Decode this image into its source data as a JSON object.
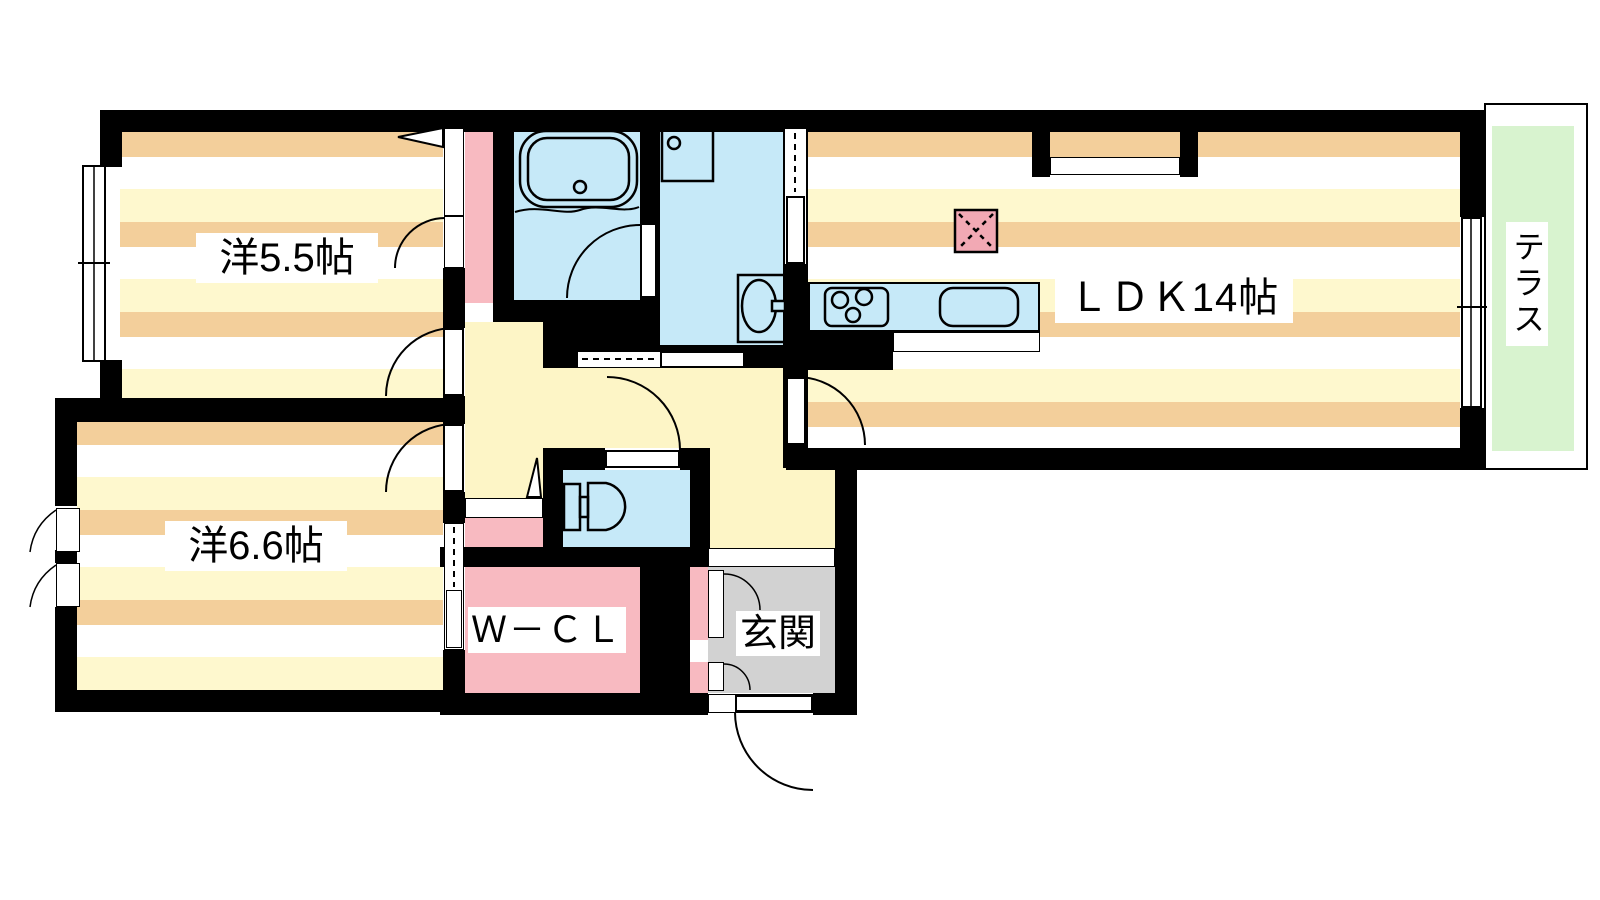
{
  "floorplan": {
    "rooms": {
      "bedroom1": {
        "label": "洋5.5帖"
      },
      "bedroom2": {
        "label": "洋6.6帖"
      },
      "ldk": {
        "label": "ＬＤＫ14帖"
      },
      "wcl": {
        "label": "Ｗ－ＣＬ"
      },
      "entrance": {
        "label": "玄関"
      },
      "terrace": {
        "label": "テラス"
      }
    },
    "fixtures": [
      "bathtub",
      "washing-machine-pan",
      "washbasin",
      "toilet",
      "gas-stove",
      "kitchen-sink",
      "range-marker",
      "entrance-step",
      "shoe-cabinet"
    ],
    "colors": {
      "wall": "#000000",
      "floor_stripe_tan": "#F3CF9B",
      "floor_stripe_yellow": "#FEF8CE",
      "hallway": "#FDF5C6",
      "wet_area_blue": "#C6E9F8",
      "closet_pink": "#F8BAC1",
      "marker_pink": "#F2A9B4",
      "entrance_gray": "#D2D2D2",
      "terrace_green": "#D8F3CF"
    }
  }
}
